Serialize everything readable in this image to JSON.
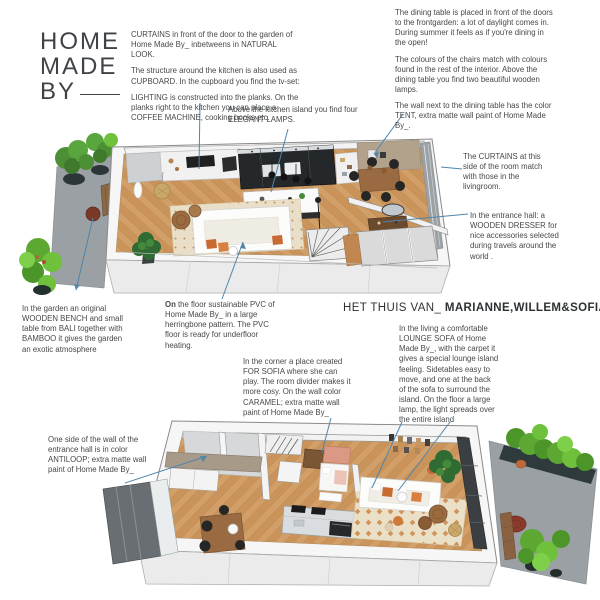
{
  "logo": {
    "line1": "HOME",
    "line2": "MADE",
    "line3": "BY"
  },
  "title": {
    "prefix": "HET THUIS VAN_",
    "names": "MARIANNE,WILLEM&SOFIA"
  },
  "notes": {
    "curtains": "CURTAINS in front of the door to the garden of Home Made By_ inbetweens in NATURAL LOOK.",
    "cupboard": "The structure around the kitchen is also used as CUPBOARD. In the cupboard you find the tv-set:",
    "lighting": "LIGHTING is constructed into the planks. On the planks right to the kitchen you can place a COFFEE MACHINE, cooking books etc.",
    "lamps": "Above the kitchen island you find four ELEGANT LAMPS.",
    "dining": "The dining table is placed in front of the doors to the frontgarden: a lot of daylight comes in. During summer it feels as if you're dining in the open!",
    "chairs": "The colours of the chairs match with colours found in the rest of the interior. Above the dining table you find two beautiful wooden lamps.",
    "tent": "The wall next to the dining table has the color TENT, extra matte wall paint of Home Made By_.",
    "curtains_side": "The CURTAINS at this side of the room match with those in the livingroom.",
    "dresser": "In the entrance hall: a WOODEN DRESSER for nice accessories selected during travels around the world .",
    "garden": "In the garden an original WOODEN BENCH and small table from BALI together with BAMBOO it gives the garden an exotic atmosphere",
    "floor_bold": "On",
    "floor_rest": " the floor sustainable PVC of Home Made By_ in a large herringbone pattern. The PVC floor is ready for underfloor heating.",
    "sofa": "In the living a comfortable LOUNGE SOFA of Home Made By_, with the carpet it gives a special lounge island feeling.  Sidetables easy to move, and one at the back of the sofa to surround the island. On the floor a large lamp, the light spreads over the entire island",
    "sofia": "In the corner a place created FOR SOFIA where she can play. The room divider makes it more cosy. On the wall color CARAMEL; extra matte wall paint of Home Made By_",
    "antiloop": "One side of the wall of the entrance hall is in color ANTILOOP; extra matte wall paint of Home Made By_"
  },
  "palette": {
    "leader_line": "#4f86ac",
    "text": "#45484b",
    "floor_wood": "#c8945f",
    "wall_tent": "#b2a28c",
    "wall_antiloop": "#a79a88",
    "wall_caramel": "#db9884",
    "patio_gray": "#9aa0a3",
    "plant_green": "#57a636",
    "accent_orange": "#c96a33",
    "cupboard_dark": "#24282a"
  }
}
